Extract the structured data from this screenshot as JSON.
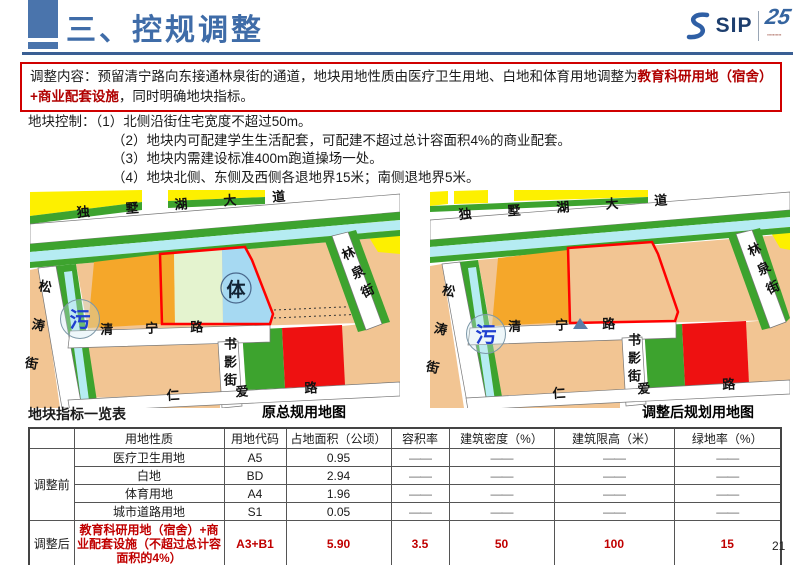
{
  "header": {
    "title": "三、控规调整",
    "logo": {
      "sip": "SIP",
      "anniversary": "25"
    }
  },
  "colors": {
    "accent_blue": "#4a74ac",
    "highlight_red": "#b00000",
    "landuse": {
      "residential_peach": "#f2c593",
      "education_orange": "#f5a72a",
      "commercial_yellow": "#fdf000",
      "green_space": "#3da32e",
      "water_cyan": "#b5ecf2",
      "white_land": "#e4f3cf",
      "sports_blue": "#a6d9f2",
      "red_block": "#ee1111",
      "plot_outline": "#ff0000"
    }
  },
  "adjustment": {
    "lead": "调整内容：预留清宁路向东接通林泉街的通道，地块用地性质由医疗卫生用地、白地和体育用地调整为",
    "highlight": "教育科研用地（宿舍）+商业配套设施",
    "tail": "，同时明确地块指标。"
  },
  "controls": {
    "lead": "地块控制：",
    "items": [
      "（1）北侧沿街住宅宽度不超过50m。",
      "（2）地块内可配建学生生活配套，可配建不超过总计容面积4%的商业配套。",
      "（3）地块内需建设标准400m跑道操场一处。",
      "（4）地块北侧、东侧及西侧各退地界15米；南侧退地界5米。"
    ]
  },
  "maps": {
    "left": {
      "caption": "原总规用地图",
      "roads": {
        "north": "独墅湖大道",
        "west": "松涛街",
        "middle": "清宁路",
        "inner": "书影街",
        "south": "仁爱路",
        "east": "林泉街"
      },
      "sports_label": "体",
      "sewage_label": "污"
    },
    "right": {
      "caption": "调整后规划用地图",
      "roads": {
        "north": "独墅湖大道",
        "west": "松涛街",
        "middle": "清宁路",
        "inner": "书影街",
        "south": "仁爱路",
        "east": "林泉街"
      },
      "sewage_label": "污"
    }
  },
  "table": {
    "title": "地块指标一览表",
    "headers": [
      "",
      "用地性质",
      "用地代码",
      "占地面积（公顷）",
      "容积率",
      "建筑密度（%）",
      "建筑限高（米）",
      "绿地率（%）"
    ],
    "before_label": "调整前",
    "after_label": "调整后",
    "dash": "——",
    "before_rows": [
      {
        "name": "医疗卫生用地",
        "code": "A5",
        "area": "0.95"
      },
      {
        "name": "白地",
        "code": "BD",
        "area": "2.94"
      },
      {
        "name": "体育用地",
        "code": "A4",
        "area": "1.96"
      },
      {
        "name": "城市道路用地",
        "code": "S1",
        "area": "0.05"
      }
    ],
    "after_row": {
      "name": "教育科研用地（宿舍）+商业配套设施（不超过总计容面积的4%）",
      "code": "A3+B1",
      "area": "5.90",
      "far": "3.5",
      "density": "50",
      "height": "100",
      "green": "15"
    }
  },
  "page_number": "21"
}
